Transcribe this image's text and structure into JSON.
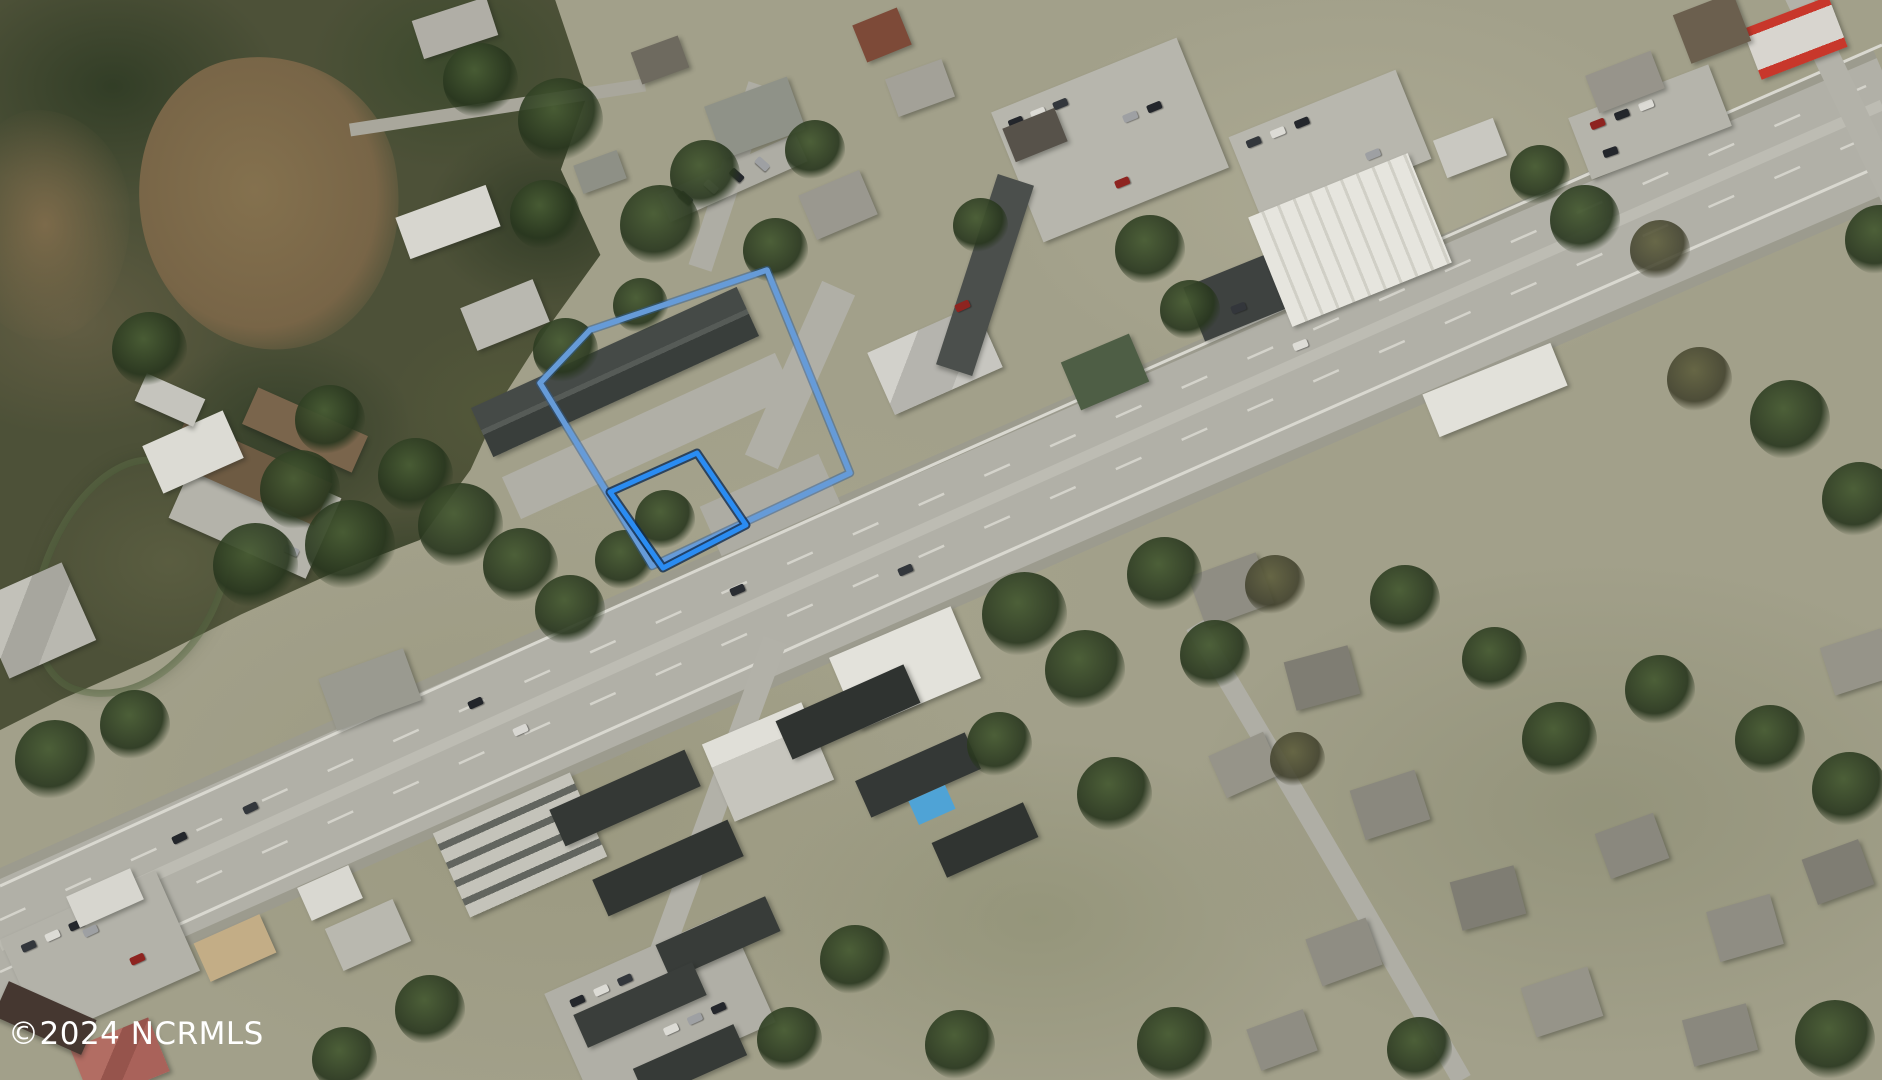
{
  "artifact_type": "real-estate-aerial-photo",
  "watermark": {
    "text": "©2024 NCRMLS",
    "color": "#ffffff"
  },
  "overlay": {
    "parcel_large": {
      "label": "large-parcel-boundary",
      "points": "767,270 590,330 540,383 652,566 850,473",
      "stroke": "#669bd8",
      "underlay_stroke": "#2e5b93"
    },
    "parcel_small": {
      "label": "small-parcel-boundary",
      "points": "610,492 697,453 746,525 663,568",
      "stroke": "#2a8cf2",
      "underlay_stroke": "#0f2c50"
    }
  },
  "scene_features": [
    "highway",
    "side-streets",
    "forest",
    "pond",
    "buildings",
    "parking-lots",
    "vehicles",
    "trees",
    "parcel-outlines"
  ]
}
